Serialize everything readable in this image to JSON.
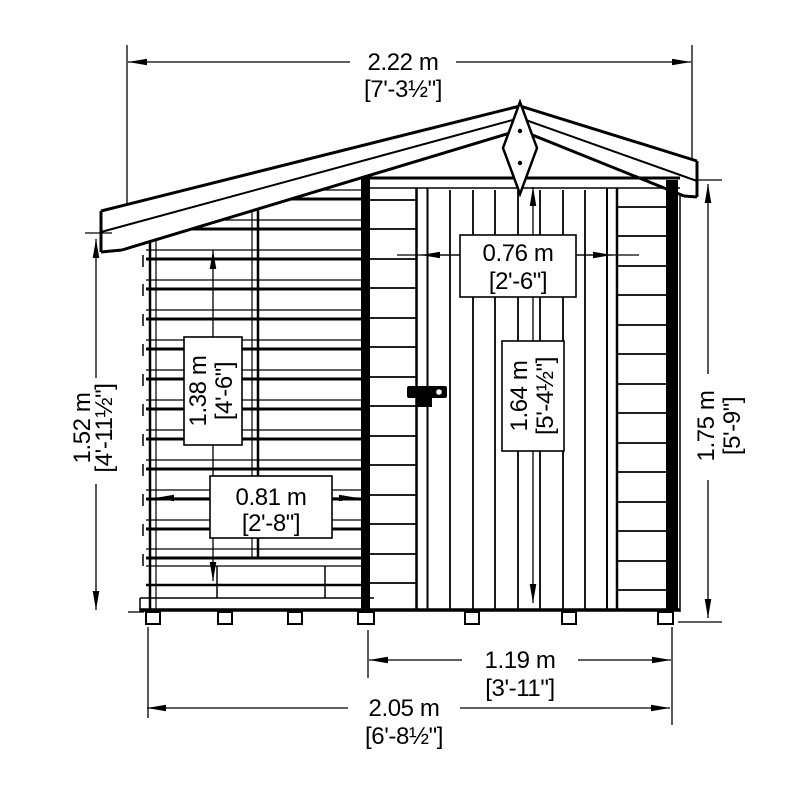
{
  "diagram": {
    "title": "shed-front-elevation-drawing",
    "background": "#ffffff",
    "line_color": "#000000",
    "dimensions": {
      "overall_width": {
        "metric": "2.22 m",
        "imperial": "[7'-3½\"]"
      },
      "left_height": {
        "metric": "1.52 m",
        "imperial": "[4'-11½\"]"
      },
      "left_opening_height": {
        "metric": "1.38 m",
        "imperial": "[4'-6\"]"
      },
      "left_opening_width": {
        "metric": "0.81 m",
        "imperial": "[2'-8\"]"
      },
      "door_width": {
        "metric": "0.76 m",
        "imperial": "[2'-6\"]"
      },
      "door_height": {
        "metric": "1.64 m",
        "imperial": "[5'-4½\"]"
      },
      "right_height": {
        "metric": "1.75 m",
        "imperial": "[5'-9\"]"
      },
      "front_width": {
        "metric": "1.19 m",
        "imperial": "[3'-11\"]"
      },
      "base_width": {
        "metric": "2.05 m",
        "imperial": "[6'-8½\"]"
      }
    }
  }
}
